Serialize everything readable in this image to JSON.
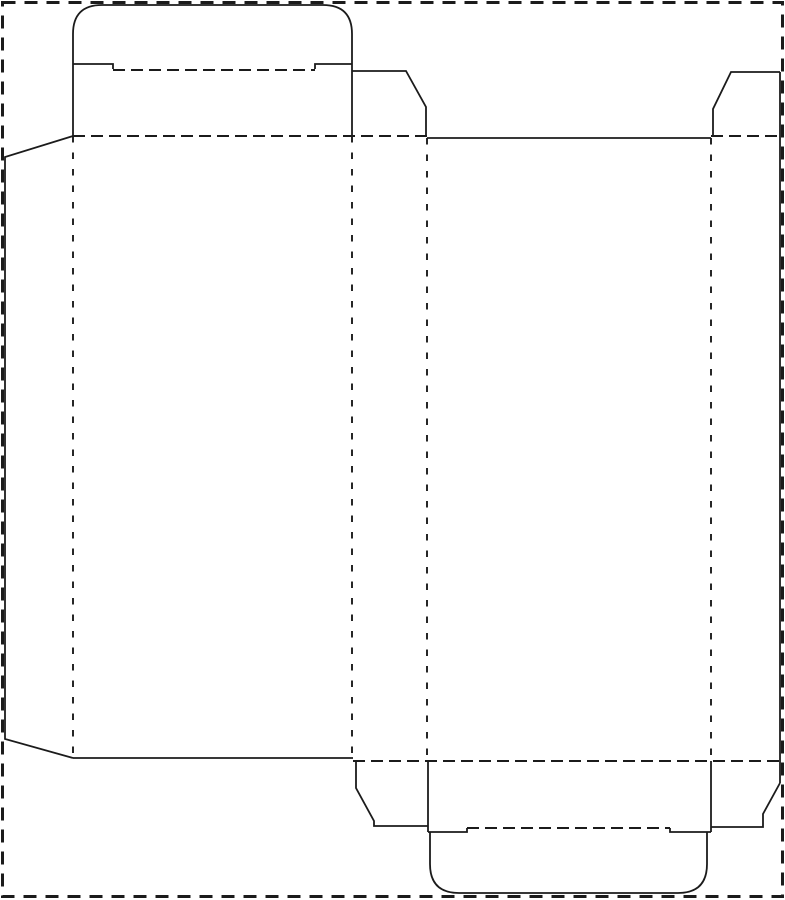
{
  "dieline": {
    "canvas": {
      "width": 785,
      "height": 900
    },
    "colors": {
      "background": "#ffffff",
      "line": "#1b1b1b"
    },
    "line_styles": {
      "cut": {
        "stroke_width": 1.8,
        "dash": "solid"
      },
      "fold_horizontal": {
        "stroke_width": 1.9,
        "dash": "12 6"
      },
      "fold_vertical": {
        "stroke_width": 1.9,
        "dash": "6.5 10"
      },
      "sheet_border": {
        "stroke_width": 3,
        "dash": "13 9"
      }
    },
    "paths": [
      {
        "name": "sheet-border",
        "style": "sheet_border",
        "d": "M2.5,2.5 L782.5,2.5 L782.5,896.5 L2.5,896.5 Z"
      },
      {
        "name": "top-tuck-flap-cut",
        "style": "cut",
        "d": "M73,64 L73,34 Q73,5 102,5 L323,5 Q352,5 352,34 L352,64"
      },
      {
        "name": "top-tuck-fold",
        "style": "fold_horizontal",
        "d": "M113,70 L315,70"
      },
      {
        "name": "top-lid-left-shoulder-cut",
        "style": "cut",
        "d": "M73,64 L113,64 L113,69"
      },
      {
        "name": "top-lid-right-shoulder-cut",
        "style": "cut",
        "d": "M315,69 L315,64 L352,64"
      },
      {
        "name": "top-lid-left-edge-cut",
        "style": "cut",
        "d": "M73,64 L73,136"
      },
      {
        "name": "top-lid-right-edge-cut",
        "style": "cut",
        "d": "M352,64 L352,136"
      },
      {
        "name": "top-panel-fold",
        "style": "fold_horizontal",
        "d": "M73,136 L427,136"
      },
      {
        "name": "top-left-dust-flap-cut",
        "style": "cut",
        "d": "M352,71 L406,71 L426,107 L426,136"
      },
      {
        "name": "back-panel-top-cut",
        "style": "cut",
        "d": "M427,138 L711,138"
      },
      {
        "name": "top-right-dust-flap-cut",
        "style": "cut",
        "d": "M713,136 L713,109 L731,72 L780,72"
      },
      {
        "name": "top-right-dust-fold",
        "style": "fold_horizontal",
        "d": "M711,136 L783,136"
      },
      {
        "name": "right-side-edge-cut",
        "style": "cut",
        "d": "M780,72 L780,783"
      },
      {
        "name": "glue-flap-cut",
        "style": "cut",
        "d": "M73,136 L5,157 L5,739 L73,758"
      },
      {
        "name": "glue-flap-fold",
        "style": "fold_v",
        "d": "M73,136 L73,758"
      },
      {
        "name": "front-left-panel-fold",
        "style": "fold_v",
        "d": "M352,136 L352,758"
      },
      {
        "name": "side-back-panel-fold",
        "style": "fold_v",
        "d": "M427,138 L427,761"
      },
      {
        "name": "back-right-panel-fold",
        "style": "fold_v",
        "d": "M711,138 L711,761"
      },
      {
        "name": "front-panel-bottom-cut",
        "style": "cut",
        "d": "M73,758 L353,758"
      },
      {
        "name": "bottom-panel-fold",
        "style": "fold_horizontal",
        "d": "M353,761 L783,761"
      },
      {
        "name": "bottom-left-dust-flap-cut",
        "style": "cut",
        "d": "M356,761 L356,788 L374,821 L374,826 L428,826"
      },
      {
        "name": "bottom-lid-left-edge-cut",
        "style": "cut",
        "d": "M428,761 L428,832"
      },
      {
        "name": "bottom-lid-right-edge-cut",
        "style": "cut",
        "d": "M711,761 L711,832"
      },
      {
        "name": "bottom-lid-left-shoulder-cut",
        "style": "cut",
        "d": "M428,832 L467,832 L467,828"
      },
      {
        "name": "bottom-lid-right-shoulder-cut",
        "style": "cut",
        "d": "M670,828 L670,832 L711,832"
      },
      {
        "name": "bottom-tuck-fold",
        "style": "fold_horizontal",
        "d": "M467,828 L670,828"
      },
      {
        "name": "bottom-tuck-flap-cut",
        "style": "cut",
        "d": "M430,832 L430,864 Q430,893 459,893 L678,893 Q707,893 707,864 L707,832"
      },
      {
        "name": "bottom-right-dust-flap-cut",
        "style": "cut",
        "d": "M780,783 L763,814 L763,827 L711,827"
      }
    ]
  }
}
